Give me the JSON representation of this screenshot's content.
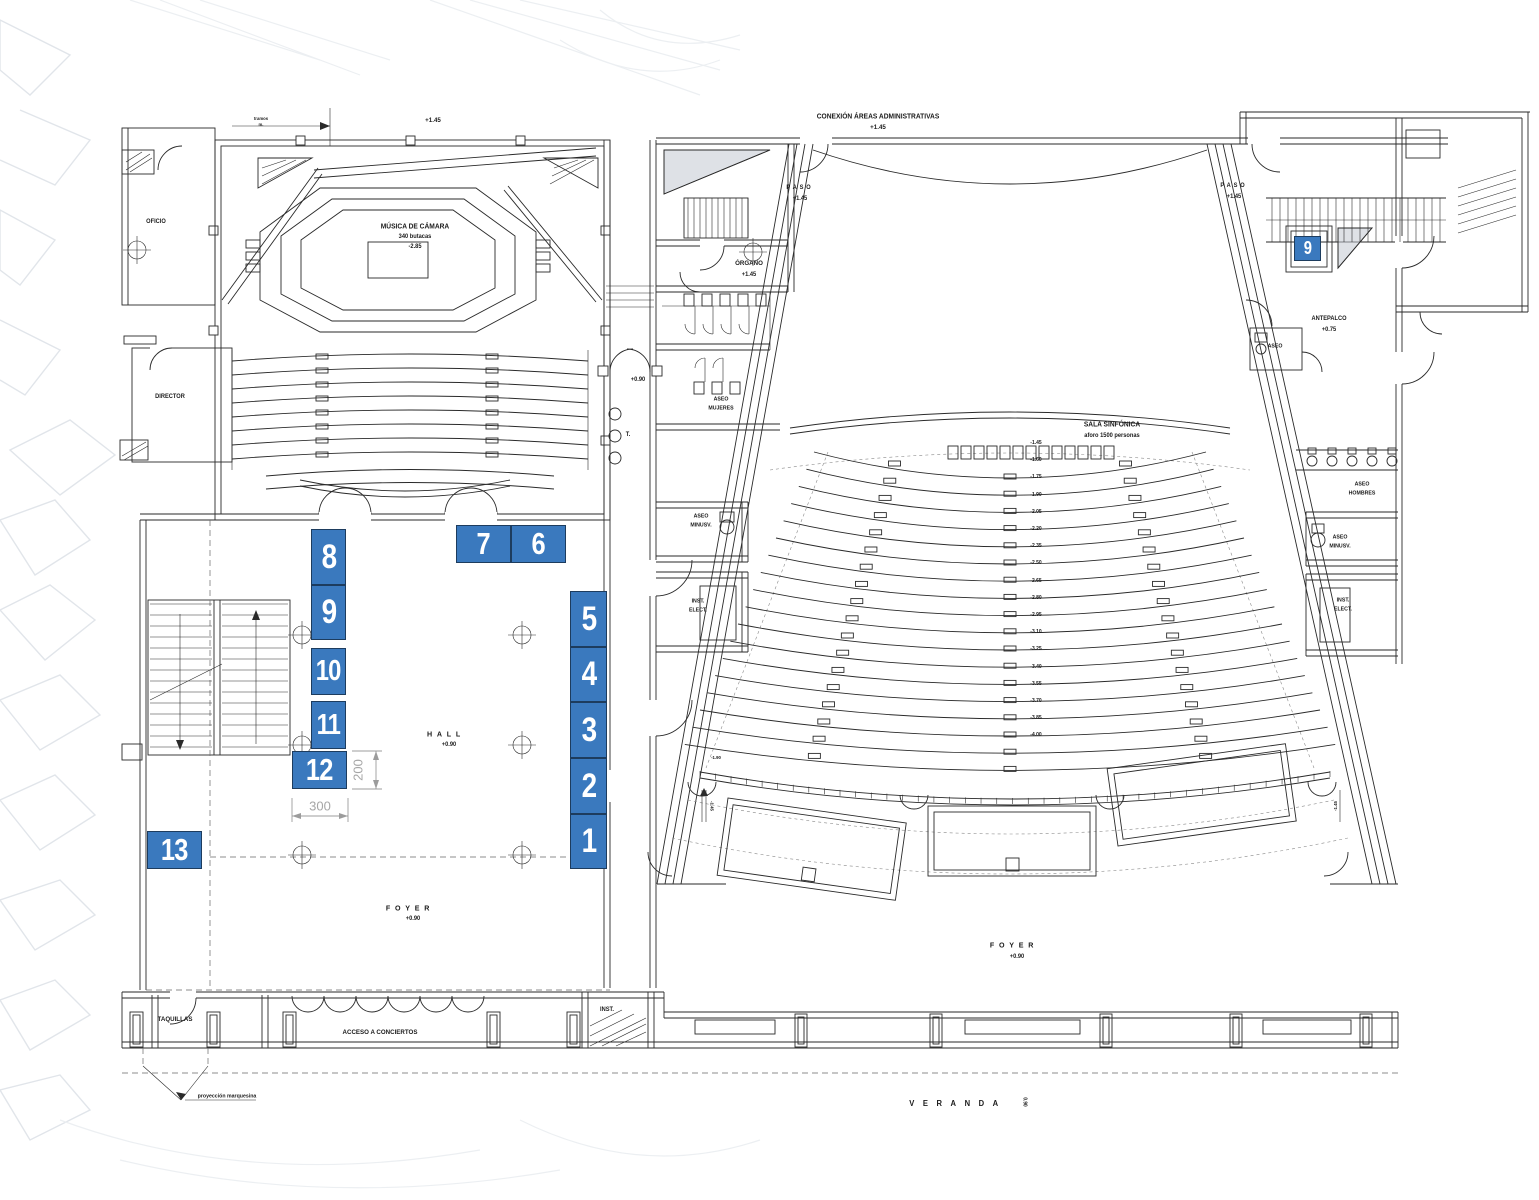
{
  "title": "Planta - Auditorio: Sala de Música de Cámara y Sala Sinfónica",
  "colors": {
    "marker_blue": "#3a79be",
    "marker_border": "#1d3c5e",
    "ink": "#2a2a2a",
    "dim_gray": "#9c9c9c",
    "background": "#ffffff"
  },
  "markers": [
    {
      "n": "1",
      "x": 570,
      "y": 814,
      "w": 37,
      "h": 55,
      "fs": 34
    },
    {
      "n": "2",
      "x": 570,
      "y": 758,
      "w": 37,
      "h": 56,
      "fs": 34
    },
    {
      "n": "3",
      "x": 570,
      "y": 702,
      "w": 37,
      "h": 56,
      "fs": 34
    },
    {
      "n": "4",
      "x": 570,
      "y": 647,
      "w": 37,
      "h": 55,
      "fs": 34
    },
    {
      "n": "5",
      "x": 570,
      "y": 591,
      "w": 37,
      "h": 56,
      "fs": 34
    },
    {
      "n": "6",
      "x": 511,
      "y": 525,
      "w": 55,
      "h": 38,
      "fs": 31
    },
    {
      "n": "7",
      "x": 456,
      "y": 525,
      "w": 55,
      "h": 38,
      "fs": 31
    },
    {
      "n": "8",
      "x": 311,
      "y": 529,
      "w": 35,
      "h": 56,
      "fs": 34
    },
    {
      "n": "9",
      "x": 311,
      "y": 585,
      "w": 35,
      "h": 55,
      "fs": 34
    },
    {
      "n": "10",
      "x": 311,
      "y": 648,
      "w": 35,
      "h": 47,
      "fs": 29
    },
    {
      "n": "11",
      "x": 311,
      "y": 701,
      "w": 35,
      "h": 48,
      "fs": 29
    },
    {
      "n": "12",
      "x": 292,
      "y": 751,
      "w": 55,
      "h": 38,
      "fs": 31
    },
    {
      "n": "13",
      "x": 147,
      "y": 831,
      "w": 55,
      "h": 38,
      "fs": 31
    },
    {
      "n": "9",
      "x": 1294,
      "y": 236,
      "w": 27,
      "h": 25,
      "fs": 18
    }
  ],
  "labels": [
    {
      "text": "CONEXIÓN ÁREAS ADMINISTRATIVAS",
      "x": 878,
      "y": 117,
      "fs": 7
    },
    {
      "text": "+1.45",
      "x": 878,
      "y": 128,
      "fs": 6.5
    },
    {
      "text": "+1.45",
      "x": 433,
      "y": 121,
      "fs": 6.5
    },
    {
      "text": "MÚSICA DE CÁMARA",
      "x": 415,
      "y": 227,
      "fs": 7
    },
    {
      "text": "340 butacas",
      "x": 415,
      "y": 237,
      "fs": 6
    },
    {
      "text": "-2.85",
      "x": 415,
      "y": 247,
      "fs": 6
    },
    {
      "text": "OFICIO",
      "x": 156,
      "y": 222,
      "fs": 6
    },
    {
      "text": "DIRECTOR",
      "x": 170,
      "y": 397,
      "fs": 6
    },
    {
      "text": "PASO",
      "x": 800,
      "y": 188,
      "fs": 6,
      "ls": 3
    },
    {
      "text": "+1.45",
      "x": 800,
      "y": 199,
      "fs": 6
    },
    {
      "text": "ÓRGANO",
      "x": 749,
      "y": 264,
      "fs": 6.5
    },
    {
      "text": "+1.45",
      "x": 749,
      "y": 275,
      "fs": 6
    },
    {
      "text": "ASEO",
      "x": 721,
      "y": 400,
      "fs": 5.5
    },
    {
      "text": "MUJERES",
      "x": 721,
      "y": 409,
      "fs": 5.5
    },
    {
      "text": "ASEO",
      "x": 701,
      "y": 517,
      "fs": 5.5
    },
    {
      "text": "MINUSV.",
      "x": 701,
      "y": 526,
      "fs": 5.5
    },
    {
      "text": "INST.",
      "x": 698,
      "y": 602,
      "fs": 5.5
    },
    {
      "text": "ELECT.",
      "x": 698,
      "y": 611,
      "fs": 5.5
    },
    {
      "text": "+0.90",
      "x": 638,
      "y": 380,
      "fs": 6
    },
    {
      "text": "T.",
      "x": 628,
      "y": 435,
      "fs": 6
    },
    {
      "text": "SALA SINFÓNICA",
      "x": 1112,
      "y": 425,
      "fs": 7
    },
    {
      "text": "aforo 1500 personas",
      "x": 1112,
      "y": 436,
      "fs": 6
    },
    {
      "text": "PASO",
      "x": 1234,
      "y": 186,
      "fs": 6,
      "ls": 3
    },
    {
      "text": "+1.45",
      "x": 1234,
      "y": 197,
      "fs": 6
    },
    {
      "text": "ANTEPALCO",
      "x": 1329,
      "y": 319,
      "fs": 6
    },
    {
      "text": "+0.75",
      "x": 1329,
      "y": 330,
      "fs": 6
    },
    {
      "text": "ASEO",
      "x": 1275,
      "y": 347,
      "fs": 5.5
    },
    {
      "text": "ASEO",
      "x": 1362,
      "y": 485,
      "fs": 5.5
    },
    {
      "text": "HOMBRES",
      "x": 1362,
      "y": 494,
      "fs": 5.5
    },
    {
      "text": "ASEO",
      "x": 1340,
      "y": 538,
      "fs": 5.5
    },
    {
      "text": "MINUSV.",
      "x": 1340,
      "y": 547,
      "fs": 5.5
    },
    {
      "text": "INST.",
      "x": 1343,
      "y": 601,
      "fs": 5.5
    },
    {
      "text": "ELECT.",
      "x": 1343,
      "y": 610,
      "fs": 5.5
    },
    {
      "text": "HALL",
      "x": 446,
      "y": 734,
      "fs": 7.5,
      "ls": 5
    },
    {
      "text": "+0.90",
      "x": 449,
      "y": 745,
      "fs": 6
    },
    {
      "text": "FOYER",
      "x": 410,
      "y": 908,
      "fs": 7.5,
      "ls": 5
    },
    {
      "text": "+0.90",
      "x": 413,
      "y": 919,
      "fs": 6
    },
    {
      "text": "FOYER",
      "x": 1014,
      "y": 945,
      "fs": 7.5,
      "ls": 5
    },
    {
      "text": "+0.90",
      "x": 1017,
      "y": 957,
      "fs": 6
    },
    {
      "text": "TAQUILLAS",
      "x": 175,
      "y": 1020,
      "fs": 6.5
    },
    {
      "text": "ACCESO A CONCIERTOS",
      "x": 380,
      "y": 1033,
      "fs": 6.5
    },
    {
      "text": "INST.",
      "x": 607,
      "y": 1010,
      "fs": 6
    },
    {
      "text": "VERANDA",
      "x": 958,
      "y": 1104,
      "fs": 8,
      "ls": 9
    },
    {
      "text": "0.90",
      "x": 1024,
      "y": 1102,
      "fs": 5,
      "rot": 90
    },
    {
      "text": "proyección marquesina",
      "x": 227,
      "y": 1097,
      "fs": 5.5
    },
    {
      "text": "tramos",
      "x": 261,
      "y": 119,
      "fs": 4.5
    },
    {
      "text": "m.",
      "x": 261,
      "y": 125,
      "fs": 4.5
    },
    {
      "text": "-1.45",
      "x": 711,
      "y": 806,
      "fs": 4.5,
      "rot": 90
    },
    {
      "text": "-1.45",
      "x": 1336,
      "y": 806,
      "fs": 4.5,
      "rot": -90
    },
    {
      "text": "-1.90",
      "x": 716,
      "y": 758,
      "fs": 4.5
    }
  ],
  "row_levels": {
    "values": [
      "-1.45",
      "-1.60",
      "-1.75",
      "-1.90",
      "-2.05",
      "-2.20",
      "-2.35",
      "-2.50",
      "-2.65",
      "-2.80",
      "-2.95",
      "-3.10",
      "-3.25",
      "-3.40",
      "-3.55",
      "-3.70",
      "-3.85",
      "-4.00"
    ]
  },
  "dimensions": {
    "width_label": "300",
    "height_label": "200"
  }
}
